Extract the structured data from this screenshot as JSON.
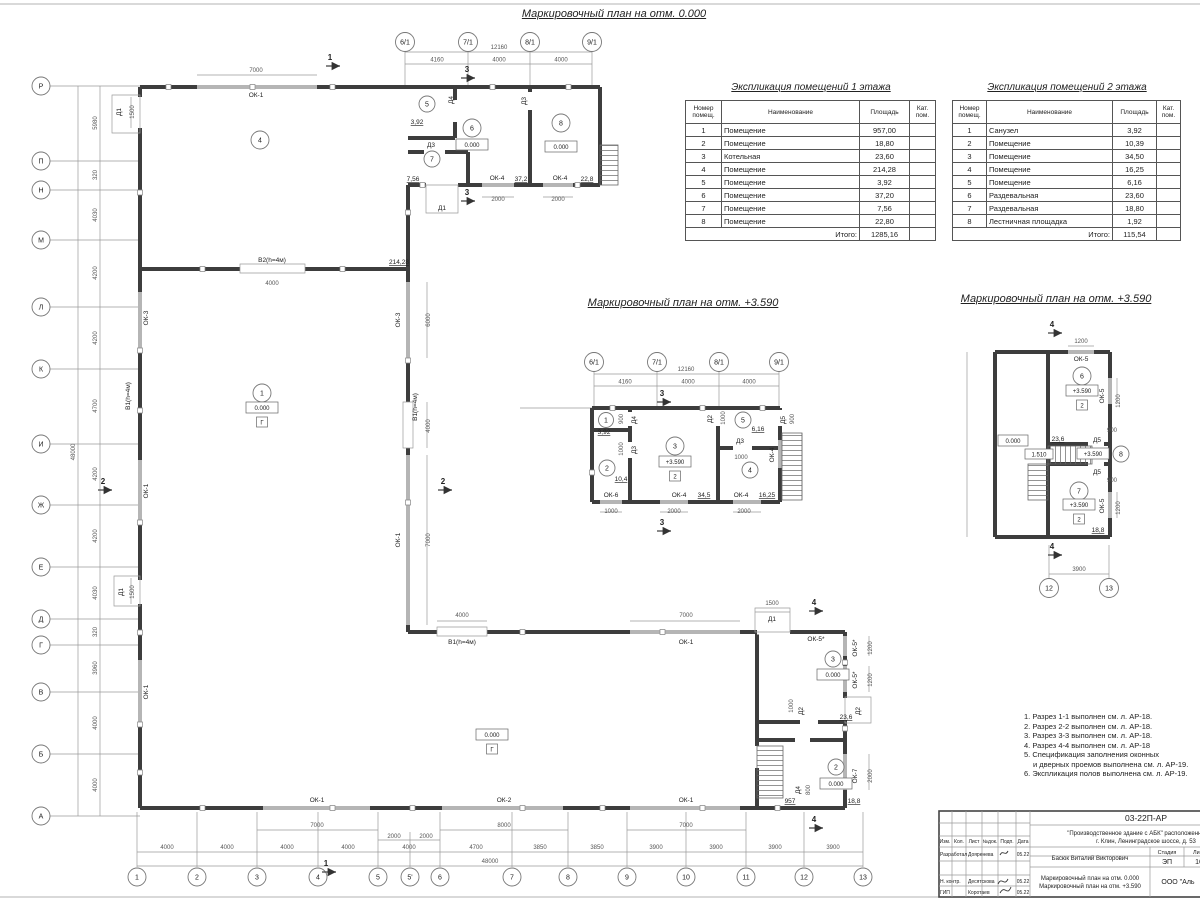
{
  "titles": {
    "plan0": "Маркировочный план на отм. 0.000",
    "plan1": "Маркировочный план на отм. +3.590",
    "plan2": "Маркировочный план на отм. +3.590"
  },
  "tables": {
    "floor1": {
      "title": "Экспликация помещений 1 этажа",
      "headers": {
        "num": "Номер помещ.",
        "name": "Наименование",
        "area": "Площадь",
        "cat": "Кат. пом."
      },
      "rows": [
        {
          "num": "1",
          "name": "Помещение",
          "area": "957,00"
        },
        {
          "num": "2",
          "name": "Помещение",
          "area": "18,80"
        },
        {
          "num": "3",
          "name": "Котельная",
          "area": "23,60"
        },
        {
          "num": "4",
          "name": "Помещение",
          "area": "214,28"
        },
        {
          "num": "5",
          "name": "Помещение",
          "area": "3,92"
        },
        {
          "num": "6",
          "name": "Помещение",
          "area": "37,20"
        },
        {
          "num": "7",
          "name": "Помещение",
          "area": "7,56"
        },
        {
          "num": "8",
          "name": "Помещение",
          "area": "22,80"
        }
      ],
      "total_label": "Итого:",
      "total": "1285,16"
    },
    "floor2": {
      "title": "Экспликация помещений 2 этажа",
      "headers": {
        "num": "Номер помещ.",
        "name": "Наименование",
        "area": "Площадь",
        "cat": "Кат. пом."
      },
      "rows": [
        {
          "num": "1",
          "name": "Санузел",
          "area": "3,92"
        },
        {
          "num": "2",
          "name": "Помещение",
          "area": "10,39"
        },
        {
          "num": "3",
          "name": "Помещение",
          "area": "34,50"
        },
        {
          "num": "4",
          "name": "Помещение",
          "area": "16,25"
        },
        {
          "num": "5",
          "name": "Помещение",
          "area": "6,16"
        },
        {
          "num": "6",
          "name": "Раздевальная",
          "area": "23,60"
        },
        {
          "num": "7",
          "name": "Раздевальная",
          "area": "18,80"
        },
        {
          "num": "8",
          "name": "Лестничная площадка",
          "area": "1,92"
        }
      ],
      "total_label": "Итого:",
      "total": "115,54"
    }
  },
  "notes": {
    "lines": [
      "1. Разрез 1-1 выполнен см. л. АР-18.",
      "2. Разрез 2-2 выполнен см. л. АР-18.",
      "3. Разрез 3-3 выполнен см. л. АР-18.",
      "4. Разрез 4-4 выполнен см. л. АР-18",
      "5. Спецификация заполнения оконных",
      "и дверных проемов выполнена см. л. АР-19.",
      "6. Экспликация полов выполнена см. л. АР-19."
    ]
  },
  "titleblock": {
    "doc_code": "03-22П-АР",
    "project_line1": "\"Производственное здание с АБК\" расположенное по ад",
    "project_line2": "г. Клин, Ленинградское шоссе, д. 53",
    "author": "Басюк Виталий Викторович",
    "stage_label": "Стадия",
    "list_label": "Лист",
    "stage": "ЭП",
    "list_num": "16",
    "cols": {
      "izm": "Изм.",
      "kol": "Кол.",
      "list": "Лист",
      "ndoc": "№док.",
      "podp": "Подп.",
      "date": "Дата"
    },
    "row1_role": "Разработал",
    "row1_name": "Дояренева",
    "row1_date": "05.22",
    "row2_role": "Н. контр.",
    "row2_name": "Десятскова",
    "row2_date": "05.22",
    "row3_role": "ГИП",
    "row3_name": "Коротаев",
    "row3_date": "05.22",
    "sheet_line1": "Маркировочный план на отм. 0.000",
    "sheet_line2": "Маркировочный план на отм. +3.590",
    "company": "ООО \"Аль"
  },
  "plan0": {
    "grid_left": [
      "Р",
      "П",
      "Н",
      "М",
      "Л",
      "К",
      "И",
      "Ж",
      "Е",
      "Д",
      "Г",
      "В",
      "Б",
      "А"
    ],
    "grid_bottom": [
      "1",
      "2",
      "3",
      "4",
      "5",
      "5'",
      "6",
      "7",
      "8",
      "9",
      "10",
      "11",
      "12",
      "13"
    ],
    "grid_top": [
      "6/1",
      "7/1",
      "8/1",
      "9/1"
    ],
    "dims_left": [
      "5980",
      "320",
      "4030",
      "4200",
      "4200",
      "4700",
      "4200",
      "4200",
      "4030",
      "320",
      "3960",
      "4000",
      "4000"
    ],
    "dim_left_total": "48000",
    "dims_bottom": [
      "4000",
      "4000",
      "4000",
      "4000",
      "4000",
      "4700",
      "3850",
      "3850",
      "3900",
      "3900",
      "3900",
      "3900"
    ],
    "dims_bottom_sub": [
      "2000",
      "2000"
    ],
    "dim_bottom_total": "48000",
    "dims_top": [
      "4160",
      "4000",
      "4000"
    ],
    "dim_top_total": "12160",
    "dims": {
      "top_window": "7000",
      "door_top": "1500",
      "gate_b2": "4000",
      "mid_ok3": "6000",
      "mid_b1": "4000",
      "mid_ok1": "7000",
      "door_left": "1500",
      "int_b1": "4000",
      "int_ok1": "7000",
      "int_d1": "1500",
      "win_b1": "7000",
      "win_b2": "8000",
      "win_b3": "7000",
      "ok4_1": "2000",
      "ok4_2": "2000",
      "ok5_1": "1200",
      "ok5_2": "1200",
      "d2": "1000",
      "ok7": "2000",
      "d4": "800"
    },
    "labels": {
      "ok1_top": "ОК-1",
      "d1_top": "Д1",
      "ok3_left": "ОК-3",
      "b1_left": "В1(h=4м)",
      "ok1_left": "ОК-1",
      "d1_left": "Д1",
      "ok1_left2": "ОК-1",
      "b2": "В2(h=4м)",
      "ok3_mid": "ОК-3",
      "b1_mid": "В1(h=4м)",
      "ok1_mid": "ОК-1",
      "b1_int": "В1(h=4м)",
      "ok1_int": "ОК-1",
      "d1_int": "Д1",
      "ok1_bot1": "ОК-1",
      "ok2_bot": "ОК-2",
      "ok1_bot2": "ОК-1",
      "ok4_a": "ОК-4",
      "ok4_b": "ОК-4",
      "ok5_a": "ОК-5*",
      "ok5_b": "ОК-5*",
      "ok5_c": "ОК-5*",
      "ok7": "ОК-7",
      "d2_a": "Д2",
      "d2_b": "Д2",
      "d3_a": "Д3",
      "d3_b": "Д3",
      "d4_a": "Д4",
      "d4_b": "Д4",
      "d1_wing": "Д1"
    },
    "rooms": {
      "r1": {
        "num": "1",
        "level": "0.000",
        "cat": "Г",
        "area": "957"
      },
      "r2": {
        "num": "2",
        "level": "0.000",
        "area": "18,8"
      },
      "r3": {
        "num": "3",
        "level": "0.000",
        "area": "23,6"
      },
      "r4": {
        "num": "4",
        "area": "214,28"
      },
      "r5": {
        "num": "5",
        "area": "3,92"
      },
      "r6": {
        "num": "6",
        "level": "0.000",
        "area": "37,2"
      },
      "r7": {
        "num": "7",
        "area": "7,56"
      },
      "r8": {
        "num": "8",
        "level": "0.000",
        "area": "22,8"
      }
    },
    "sections": {
      "s1": "1",
      "s2": "2",
      "s3": "3",
      "s4": "4"
    }
  },
  "plan1": {
    "grid_top": [
      "6/1",
      "7/1",
      "8/1",
      "9/1"
    ],
    "dims_top": [
      "4160",
      "4000",
      "4000"
    ],
    "dim_top_total": "12160",
    "dims_bottom": [
      "1000",
      "2000",
      "2000"
    ],
    "dims": {
      "d4": "900",
      "d3a": "1000",
      "d2": "1000",
      "d3b": "1000",
      "d5": "900"
    },
    "labels": {
      "ok6": "ОК-6",
      "ok4_a": "ОК-4",
      "ok4_b": "ОК-4",
      "ok4_r": "ОК-4",
      "d4": "Д4",
      "d3a": "Д3",
      "d2": "Д2",
      "d3b": "Д3",
      "d5": "Д5"
    },
    "rooms": {
      "r1": {
        "num": "1",
        "area": "3,92"
      },
      "r2": {
        "num": "2",
        "area": "10,4"
      },
      "r3": {
        "num": "3",
        "level": "+3.590",
        "cat": "2",
        "area": "34,5"
      },
      "r4": {
        "num": "4",
        "area": "16,25"
      },
      "r5": {
        "num": "5",
        "area": "6,16"
      }
    },
    "section": "3"
  },
  "plan2": {
    "grid_bottom": [
      "12",
      "13"
    ],
    "dim_bottom": "3900",
    "dims": {
      "ok5_top": "1200",
      "ok5_r1": "1200",
      "ok5_r2": "1200",
      "d5a": "900",
      "d5b": "900"
    },
    "labels": {
      "ok5_top": "ОК-5",
      "ok5_r1": "ОК-5",
      "ok5_r2": "ОК-5",
      "d5a": "Д5",
      "d5b": "Д5"
    },
    "levels": {
      "hall": "0.000",
      "stair": "1.510",
      "landing": "+3.590"
    },
    "rooms": {
      "r6": {
        "num": "6",
        "level": "+3.590",
        "cat": "2",
        "area": "23,6"
      },
      "r7": {
        "num": "7",
        "level": "+3.590",
        "cat": "2",
        "area": "18,8"
      },
      "r8": {
        "num": "8"
      }
    },
    "section": "4"
  }
}
